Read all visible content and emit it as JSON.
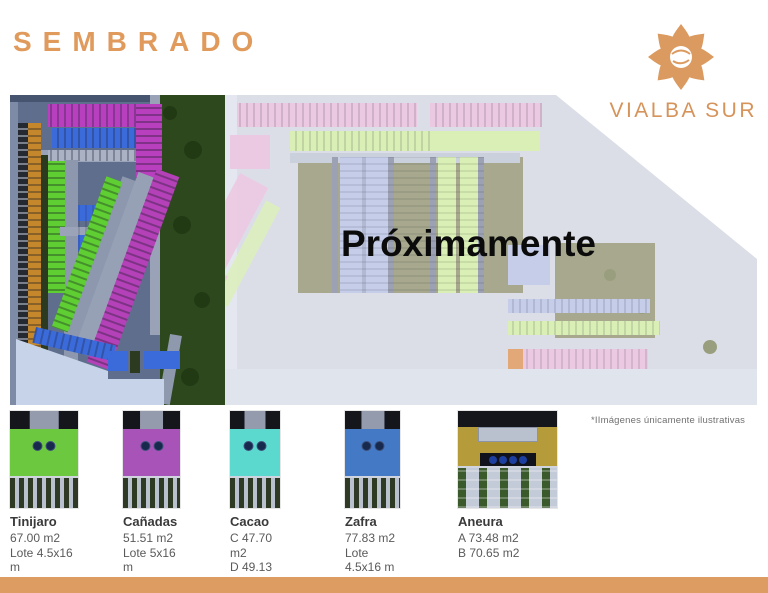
{
  "header": {
    "title": "SEMBRADO"
  },
  "brand": {
    "name": "VIALBA SUR",
    "logo_icon": "vialba-flower-icon",
    "accent_color": "#DB9A60"
  },
  "map": {
    "coming_soon": "Próximamente",
    "palette": {
      "active_bg": "#5F6E8D",
      "park_green": "#2E481E",
      "row_orange": "#C5872B",
      "row_magenta": "#B83FBE",
      "row_blue": "#3B6BDA",
      "row_green": "#5FCE33",
      "upcoming_bg": "#DBDEE7",
      "row_pink": "#EBC9E2",
      "row_lightgreen": "#D9EFB5",
      "row_lightblue": "#C5CDE9",
      "row_mint": "#CDEBDB",
      "ground_olive": "#A7A88D"
    }
  },
  "legend": {
    "items": [
      {
        "name": "Tinijaro",
        "color": "#6CC93F",
        "lines": [
          "67.00 m2",
          "Lote 4.5x16 m"
        ]
      },
      {
        "name": "Cañadas",
        "color": "#A853B8",
        "lines": [
          "51.51 m2",
          "Lote 5x16 m"
        ]
      },
      {
        "name": "Cacao",
        "color": "#5CD9CF",
        "lines": [
          "C 47.70 m2",
          "D 49.13 m2",
          "Lote 5xx16 m"
        ]
      },
      {
        "name": "Zafra",
        "color": "#4379C5",
        "lines": [
          "77.83 m2",
          "Lote 4.5x16 m"
        ]
      },
      {
        "name": "Aneura",
        "color": "#B59B3A",
        "lines": [
          "A 73.48 m2",
          "B 70.65 m2"
        ]
      }
    ],
    "disclaimer": "*IImágenes únicamente ilustrativas"
  },
  "footer": {
    "bar_color": "#DC9C62"
  }
}
